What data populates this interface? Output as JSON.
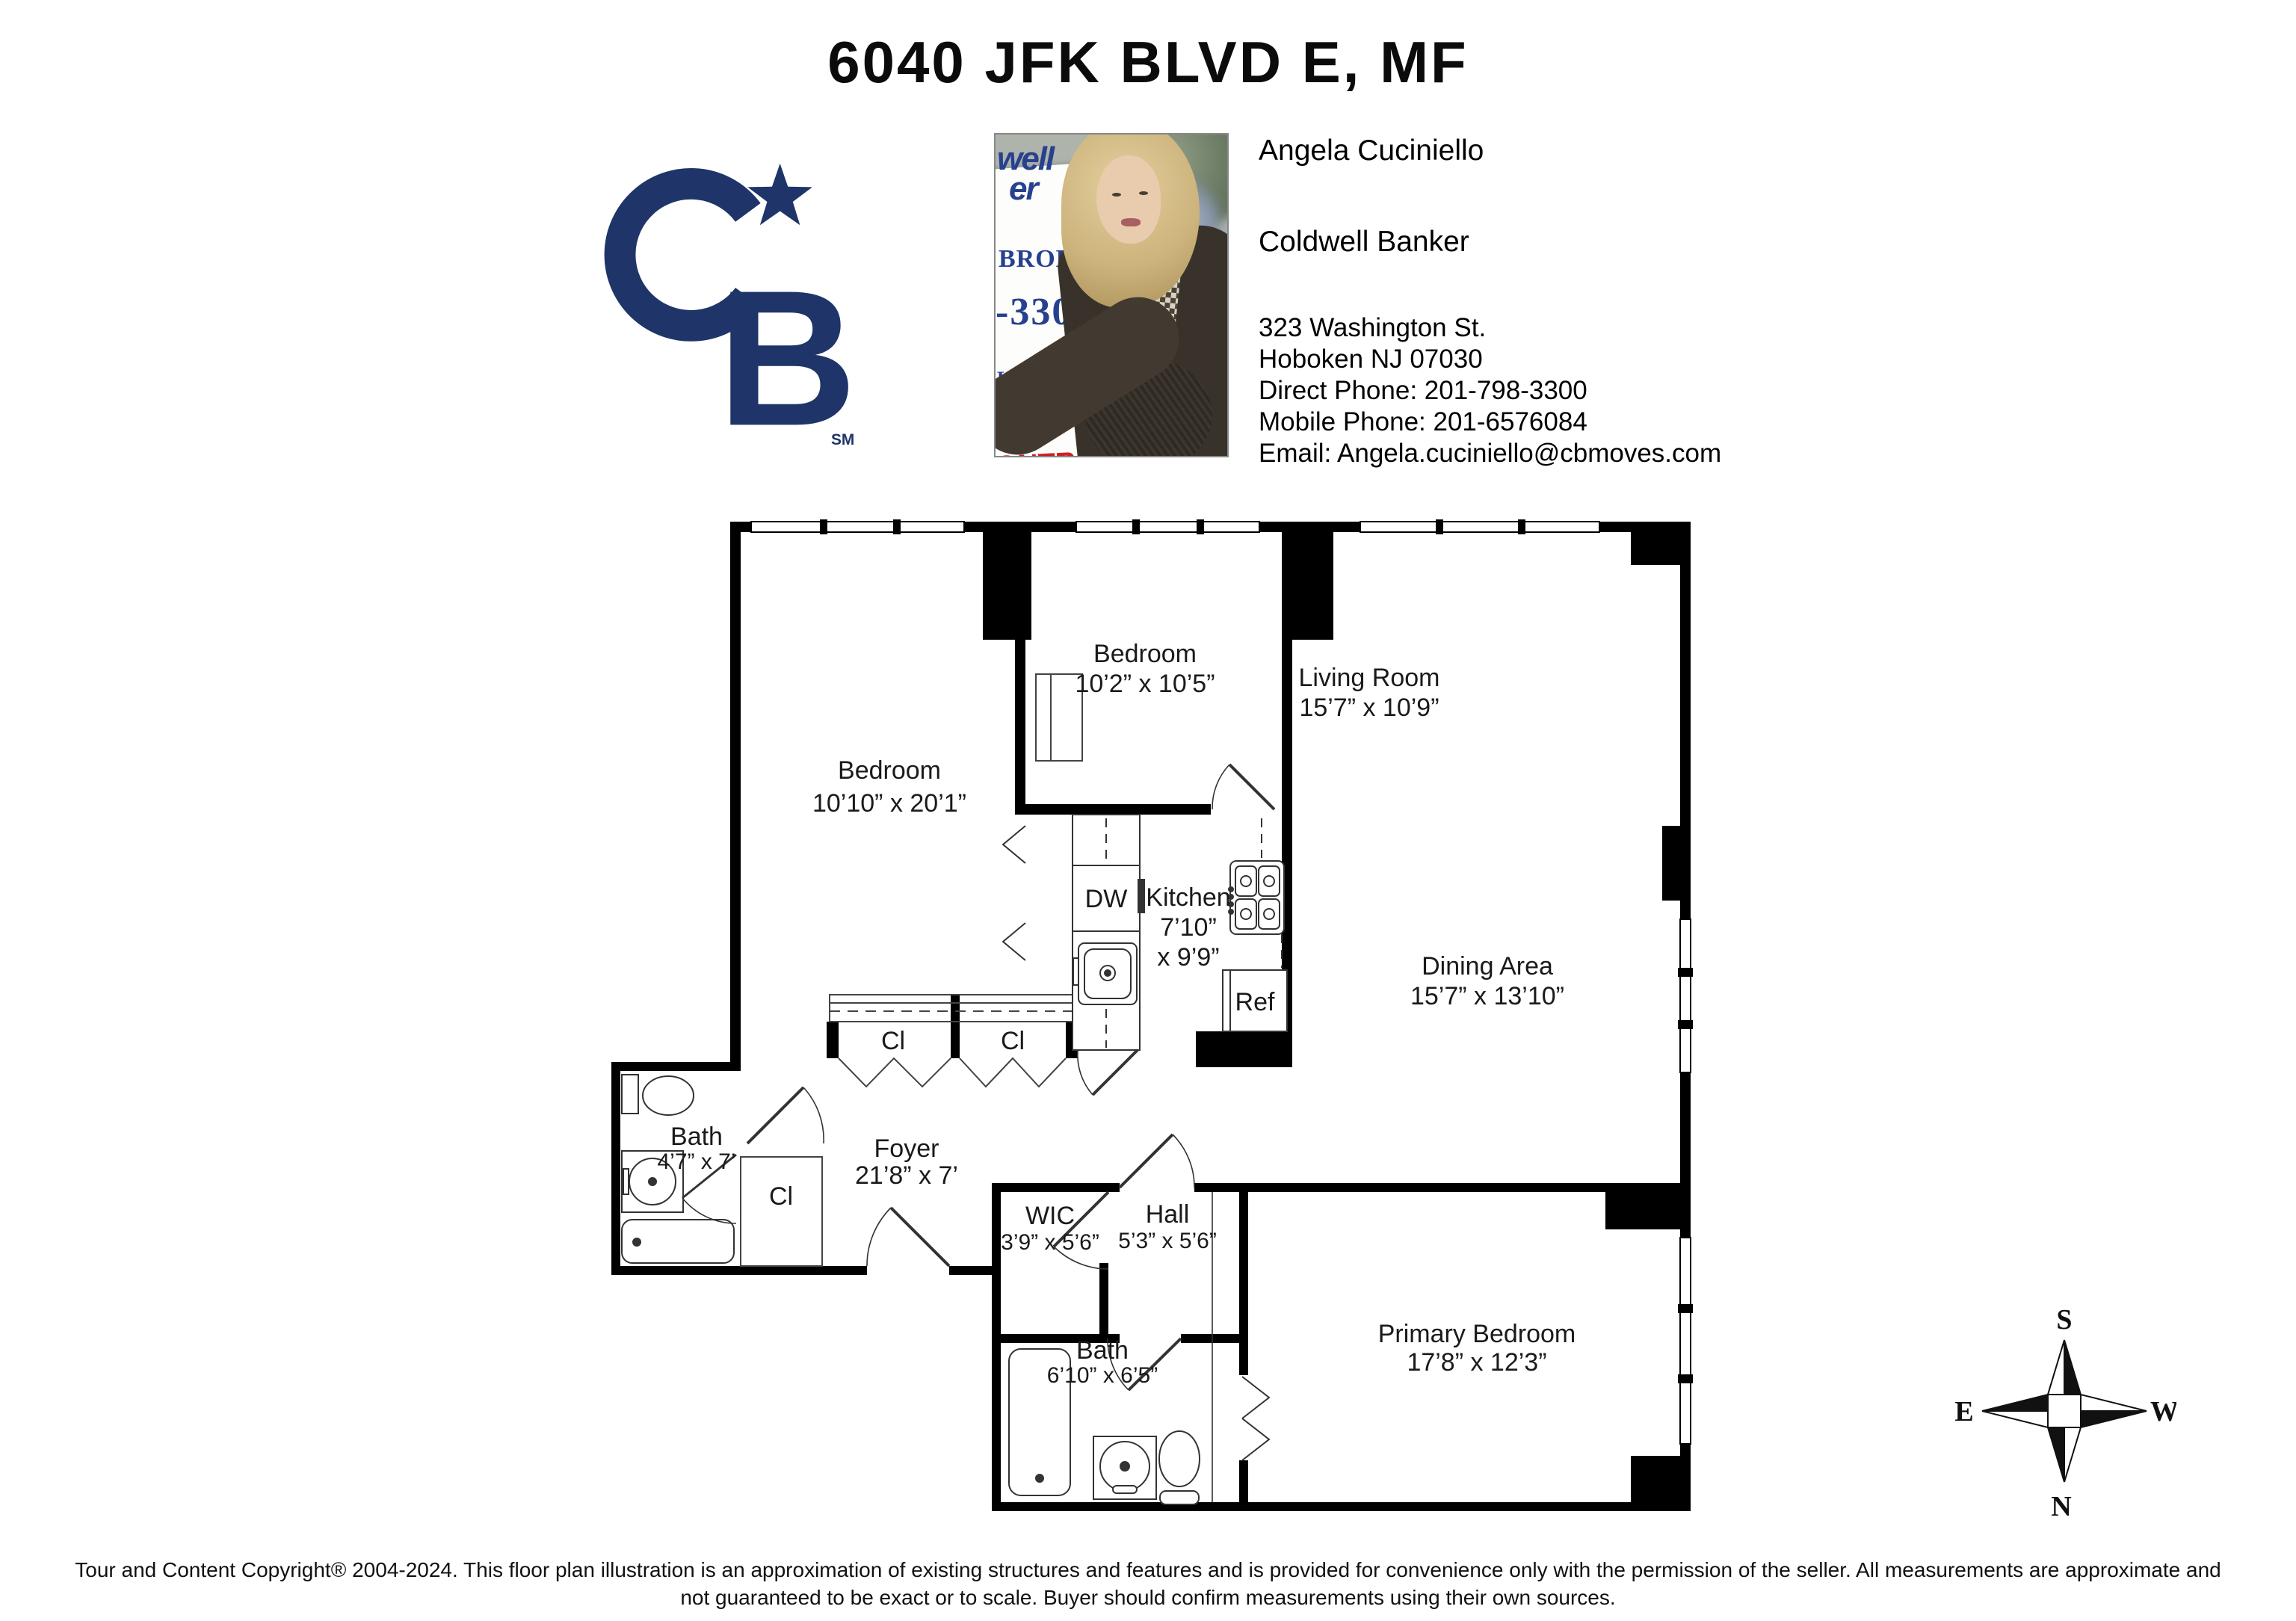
{
  "header": {
    "title": "6040 JFK BLVD E, MF",
    "logo": {
      "letter_b": "B",
      "sm": "SM",
      "color": "#1f3468"
    }
  },
  "agent": {
    "name": "Angela Cuciniello",
    "company": "Coldwell Banker",
    "address_line1": "323 Washington St.",
    "address_line2": "Hoboken NJ 07030",
    "direct_phone": "Direct Phone: 201-798-3300",
    "mobile_phone": "Mobile Phone: 201-6576084",
    "email": "Email: Angela.cuciniello@cbmoves.com"
  },
  "photo": {
    "sign_fragments": {
      "f1": "well",
      "f2": "er",
      "f3": "BROKER",
      "f4": "-3300",
      "f5": "LA CUCINIE",
      "f6": "657-608",
      "f7": "ONTRA"
    }
  },
  "floorplan": {
    "rooms": {
      "bedroom1": {
        "name": "Bedroom",
        "dims": "10’10” x 20’1”"
      },
      "bedroom2": {
        "name": "Bedroom",
        "dims": "10’2” x 10’5”"
      },
      "living": {
        "name": "Living Room",
        "dims": "15’7” x 10’9”"
      },
      "dining": {
        "name": "Dining Area",
        "dims": "15’7” x 13’10”"
      },
      "kitchen": {
        "name": "Kitchen",
        "dims_line1": "7’10”",
        "dims_line2": "x 9’9”"
      },
      "foyer": {
        "name": "Foyer",
        "dims": "21’8” x 7’"
      },
      "bath1": {
        "name": "Bath",
        "dims": "4’7” x 7’"
      },
      "wic": {
        "name": "WIC",
        "dims": "3’9” x 5’6”"
      },
      "hall": {
        "name": "Hall",
        "dims": "5’3” x 5’6”"
      },
      "bath2": {
        "name": "Bath",
        "dims": "6’10” x 6’5”"
      },
      "primary": {
        "name": "Primary Bedroom",
        "dims": "17’8” x 12’3”"
      }
    },
    "labels": {
      "dishwasher": "DW",
      "refrigerator": "Ref",
      "closet": "Cl"
    },
    "compass": {
      "n": "N",
      "s": "S",
      "e": "E",
      "w": "W"
    }
  },
  "footer": {
    "line1": "Tour and Content Copyright® 2004-2024. This floor plan illustration is an approximation of existing structures and features and is provided for convenience only with the permission of the seller. All measurements are approximate and",
    "line2": "not guaranteed to be exact or to scale. Buyer should confirm measurements using their own sources."
  }
}
